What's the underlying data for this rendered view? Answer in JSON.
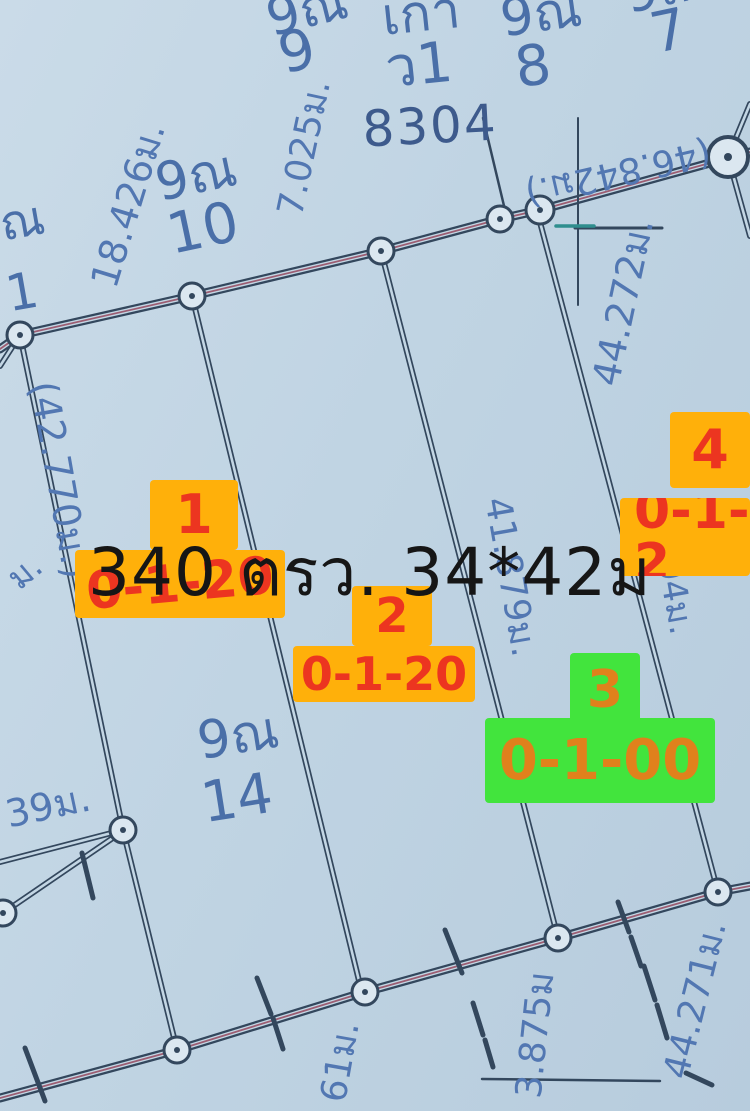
{
  "map_title": {
    "area_overlay": "340 ตรว. 34*42ม"
  },
  "survey_number": "8304",
  "plots": [
    {
      "number": "1",
      "area_code": "0-1-20",
      "highlight": "orange"
    },
    {
      "number": "2",
      "area_code": "0-1-20",
      "highlight": "orange"
    },
    {
      "number": "3",
      "area_code": "0-1-00",
      "highlight": "green"
    },
    {
      "number": "4",
      "area_code": "0-1-2",
      "highlight": "orange"
    }
  ],
  "parcel_ids": [
    {
      "prefix": "9ณ",
      "number": "9"
    },
    {
      "prefix": "เกา",
      "number": "ว1"
    },
    {
      "prefix": "9ณ",
      "number": "8"
    },
    {
      "prefix": "9ณ",
      "number": "7"
    },
    {
      "prefix": "9ณ",
      "number": "10"
    },
    {
      "prefix": "ณ",
      "number": "1"
    },
    {
      "prefix": "9ณ",
      "number": "14"
    }
  ],
  "measurements": {
    "left_top": "18.426ม.",
    "top_mid": "7.025ม.",
    "top_road": "(46.842ม.)",
    "left_boundary": "(42.770ม.)",
    "right_upper": "44.272ม.",
    "center": "41.879ม.",
    "right_mid_partial": "(04ม.",
    "right_lower": "44.271ม.",
    "bottom_center": "3.875ม",
    "bottom_partial": "61ม.",
    "left_lower": "39ม.",
    "left_mid_partial": "ม."
  },
  "colors": {
    "background": "#c0d4e3",
    "map_line": "#33475d",
    "road_accent": "#9c5d72",
    "blue_text": "#4a6fa8",
    "highlight_orange": "#ffb00a",
    "highlight_green": "#42e43d",
    "label_red": "#ec3520",
    "label_orange_on_green": "#e0811c",
    "area_text": "#161616",
    "tick_teal": "#2f8e8e"
  }
}
